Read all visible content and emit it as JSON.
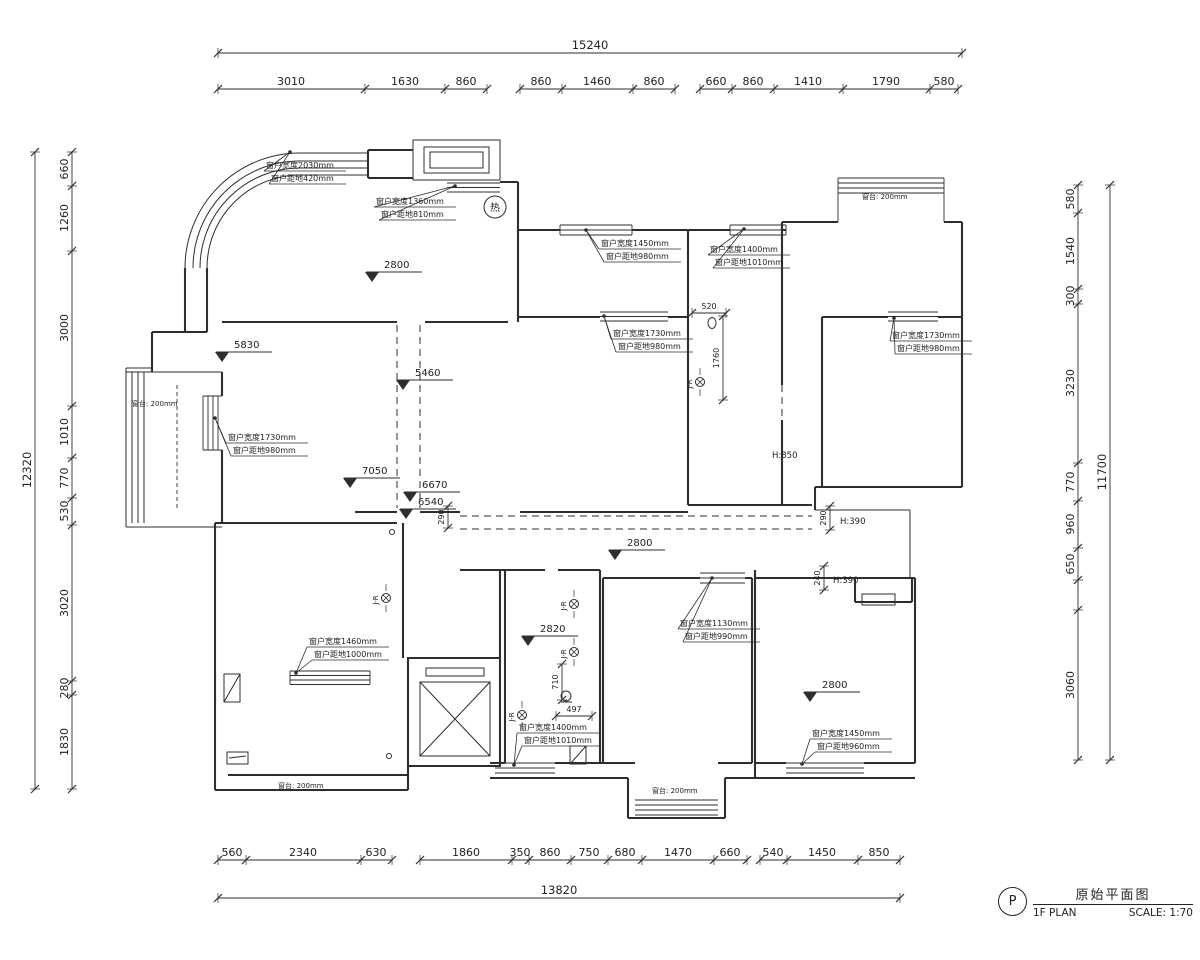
{
  "colors": {
    "line": "#2e2e2e",
    "background": "#ffffff"
  },
  "title_block": {
    "tag": "P",
    "title": "原始平面图",
    "subtitle": "1F PLAN",
    "scale": "SCALE: 1:70"
  },
  "dim_chains": [
    {
      "dir": "h",
      "y": 53,
      "from": 218,
      "to": 962,
      "ticks": [
        218,
        962
      ],
      "total": true,
      "labels": [
        {
          "pos": 590,
          "t": "15240"
        }
      ]
    },
    {
      "dir": "h",
      "y": 89,
      "from": 218,
      "to": 487,
      "ticks": [
        218,
        365,
        445,
        487
      ],
      "labels": [
        {
          "pos": 291,
          "t": "3010"
        },
        {
          "pos": 405,
          "t": "1630"
        },
        {
          "pos": 466,
          "t": "860"
        }
      ]
    },
    {
      "dir": "h",
      "y": 89,
      "from": 520,
      "to": 675,
      "ticks": [
        520,
        562,
        633,
        675
      ],
      "labels": [
        {
          "pos": 541,
          "t": "860"
        },
        {
          "pos": 597,
          "t": "1460"
        },
        {
          "pos": 654,
          "t": "860"
        }
      ]
    },
    {
      "dir": "h",
      "y": 89,
      "from": 700,
      "to": 958,
      "ticks": [
        700,
        732,
        774,
        843,
        930,
        958
      ],
      "labels": [
        {
          "pos": 716,
          "t": "660"
        },
        {
          "pos": 753,
          "t": "860"
        },
        {
          "pos": 808,
          "t": "1410"
        },
        {
          "pos": 886,
          "t": "1790"
        },
        {
          "pos": 944,
          "t": "580"
        }
      ]
    },
    {
      "dir": "v",
      "x": 35,
      "from": 152,
      "to": 789,
      "ticks": [
        152,
        789
      ],
      "total": true,
      "labels": [
        {
          "pos": 470,
          "t": "12320"
        }
      ]
    },
    {
      "dir": "v",
      "x": 72,
      "from": 152,
      "to": 789,
      "ticks": [
        152,
        186,
        251,
        406,
        458,
        498,
        525,
        681,
        695,
        789
      ],
      "labels": [
        {
          "pos": 169,
          "t": "660"
        },
        {
          "pos": 218,
          "t": "1260"
        },
        {
          "pos": 328,
          "t": "3000"
        },
        {
          "pos": 432,
          "t": "1010"
        },
        {
          "pos": 478,
          "t": "770"
        },
        {
          "pos": 511,
          "t": "530"
        },
        {
          "pos": 603,
          "t": "3020"
        },
        {
          "pos": 688,
          "t": "280"
        },
        {
          "pos": 742,
          "t": "1830"
        }
      ]
    },
    {
      "dir": "v",
      "x": 1110,
      "from": 185,
      "to": 760,
      "ticks": [
        185,
        760
      ],
      "total": true,
      "labels": [
        {
          "pos": 472,
          "t": "11700"
        }
      ]
    },
    {
      "dir": "v",
      "x": 1078,
      "from": 185,
      "to": 760,
      "ticks": [
        185,
        213,
        289,
        304,
        463,
        501,
        548,
        580,
        610,
        760
      ],
      "labels": [
        {
          "pos": 199,
          "t": "580"
        },
        {
          "pos": 251,
          "t": "1540"
        },
        {
          "pos": 296,
          "t": "300"
        },
        {
          "pos": 383,
          "t": "3230"
        },
        {
          "pos": 482,
          "t": "770"
        },
        {
          "pos": 524,
          "t": "960"
        },
        {
          "pos": 564,
          "t": "650"
        },
        {
          "pos": 685,
          "t": "3060"
        }
      ]
    },
    {
      "dir": "h",
      "y": 860,
      "from": 218,
      "to": 392,
      "ticks": [
        218,
        246,
        361,
        392
      ],
      "labels": [
        {
          "pos": 232,
          "t": "560"
        },
        {
          "pos": 303,
          "t": "2340"
        },
        {
          "pos": 376,
          "t": "630"
        }
      ]
    },
    {
      "dir": "h",
      "y": 860,
      "from": 420,
      "to": 747,
      "ticks": [
        420,
        512,
        529,
        571,
        608,
        642,
        714,
        747
      ],
      "labels": [
        {
          "pos": 466,
          "t": "1860"
        },
        {
          "pos": 520,
          "t": "350"
        },
        {
          "pos": 550,
          "t": "860"
        },
        {
          "pos": 589,
          "t": "750"
        },
        {
          "pos": 625,
          "t": "680"
        },
        {
          "pos": 678,
          "t": "1470"
        },
        {
          "pos": 730,
          "t": "660"
        }
      ]
    },
    {
      "dir": "h",
      "y": 860,
      "from": 760,
      "to": 900,
      "ticks": [
        760,
        787,
        858,
        900
      ],
      "labels": [
        {
          "pos": 773,
          "t": "540"
        },
        {
          "pos": 822,
          "t": "1450"
        },
        {
          "pos": 879,
          "t": "850"
        }
      ]
    },
    {
      "dir": "h",
      "y": 898,
      "from": 218,
      "to": 900,
      "ticks": [
        218,
        900
      ],
      "total": true,
      "labels": [
        {
          "pos": 559,
          "t": "13820"
        }
      ]
    },
    {
      "dir": "h",
      "y": 313,
      "from": 692,
      "to": 726,
      "ticks": [
        692,
        726
      ],
      "small": true,
      "labels": [
        {
          "pos": 709,
          "t": "520"
        }
      ]
    },
    {
      "dir": "h",
      "y": 716,
      "from": 556,
      "to": 592,
      "ticks": [
        556,
        592
      ],
      "small": true,
      "labels": [
        {
          "pos": 574,
          "t": "497"
        }
      ]
    },
    {
      "dir": "v",
      "x": 723,
      "from": 316,
      "to": 400,
      "ticks": [
        316,
        400
      ],
      "small": true,
      "labels": [
        {
          "pos": 358,
          "t": "1760"
        }
      ]
    },
    {
      "dir": "v",
      "x": 448,
      "from": 506,
      "to": 528,
      "ticks": [
        506,
        528
      ],
      "small": true,
      "labels": [
        {
          "pos": 517,
          "t": "290"
        }
      ]
    },
    {
      "dir": "v",
      "x": 830,
      "from": 506,
      "to": 530,
      "ticks": [
        506,
        530
      ],
      "small": true,
      "labels": [
        {
          "pos": 518,
          "t": "290"
        }
      ]
    },
    {
      "dir": "v",
      "x": 824,
      "from": 566,
      "to": 590,
      "ticks": [
        566,
        590
      ],
      "small": true,
      "labels": [
        {
          "pos": 578,
          "t": "240"
        }
      ]
    },
    {
      "dir": "v",
      "x": 562,
      "from": 664,
      "to": 700,
      "ticks": [
        664,
        700
      ],
      "small": true,
      "labels": [
        {
          "pos": 682,
          "t": "710"
        }
      ]
    }
  ],
  "levels": [
    {
      "t": "2800",
      "x": 372,
      "y": 272
    },
    {
      "t": "5830",
      "x": 222,
      "y": 352
    },
    {
      "t": "5460",
      "x": 403,
      "y": 380
    },
    {
      "t": "7050",
      "x": 350,
      "y": 478
    },
    {
      "t": "6670",
      "x": 410,
      "y": 492
    },
    {
      "t": "6540",
      "x": 406,
      "y": 509
    },
    {
      "t": "2800",
      "x": 615,
      "y": 550
    },
    {
      "t": "2820",
      "x": 528,
      "y": 636
    },
    {
      "t": "2800",
      "x": 810,
      "y": 692
    }
  ],
  "window_annotations": [
    {
      "l1": "窗户宽度2030mm",
      "l2": "窗户距地420mm",
      "x": 266,
      "y": 160,
      "ax": 290,
      "ay": 152
    },
    {
      "l1": "窗户宽度1360mm",
      "l2": "窗户距地810mm",
      "x": 376,
      "y": 196,
      "ax": 455,
      "ay": 186
    },
    {
      "l1": "窗户宽度1450mm",
      "l2": "窗户距地980mm",
      "x": 601,
      "y": 238,
      "ax": 586,
      "ay": 230
    },
    {
      "l1": "窗户宽度1400mm",
      "l2": "窗户距地1010mm",
      "x": 710,
      "y": 244,
      "ax": 744,
      "ay": 229
    },
    {
      "l1": "窗户宽度1730mm",
      "l2": "窗户距地980mm",
      "x": 613,
      "y": 328,
      "ax": 604,
      "ay": 316
    },
    {
      "l1": "窗户宽度1730mm",
      "l2": "窗户距地980mm",
      "x": 892,
      "y": 330,
      "ax": 894,
      "ay": 318
    },
    {
      "l1": "窗户宽度1730mm",
      "l2": "窗户距地980mm",
      "x": 228,
      "y": 432,
      "ax": 215,
      "ay": 418
    },
    {
      "l1": "窗户宽度1460mm",
      "l2": "窗户距地1000mm",
      "x": 309,
      "y": 636,
      "ax": 296,
      "ay": 673
    },
    {
      "l1": "窗户宽度1130mm",
      "l2": "窗户距地990mm",
      "x": 680,
      "y": 618,
      "ax": 712,
      "ay": 578
    },
    {
      "l1": "窗户宽度1400mm",
      "l2": "窗户距地1010mm",
      "x": 519,
      "y": 722,
      "ax": 514,
      "ay": 765
    },
    {
      "l1": "窗户宽度1450mm",
      "l2": "窗户距地960mm",
      "x": 812,
      "y": 728,
      "ax": 802,
      "ay": 764
    }
  ],
  "sill_labels": [
    {
      "t": "窗台: 200mm",
      "x": 132,
      "y": 406
    },
    {
      "t": "窗台: 200mm",
      "x": 862,
      "y": 199
    },
    {
      "t": "窗台: 200mm",
      "x": 278,
      "y": 788
    },
    {
      "t": "窗台: 200mm",
      "x": 652,
      "y": 793
    }
  ],
  "height_labels": [
    {
      "t": "H:850",
      "x": 772,
      "y": 458
    },
    {
      "t": "H:390",
      "x": 840,
      "y": 524
    },
    {
      "t": "H:390",
      "x": 833,
      "y": 583
    }
  ],
  "jr_markers": {
    "label": "J-R",
    "points": [
      {
        "x": 700,
        "y": 382
      },
      {
        "x": 386,
        "y": 598
      },
      {
        "x": 574,
        "y": 604
      },
      {
        "x": 574,
        "y": 652
      },
      {
        "x": 522,
        "y": 715
      }
    ]
  },
  "hot_symbol": {
    "t": "热",
    "x": 495,
    "y": 207
  }
}
